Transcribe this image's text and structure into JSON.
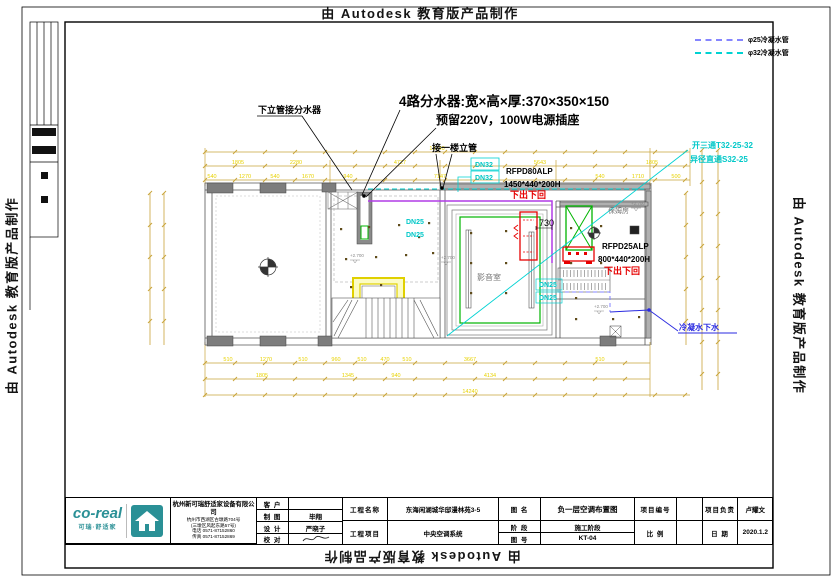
{
  "watermark": {
    "text": "由 Autodesk 教育版产品制作"
  },
  "legend": {
    "items": [
      {
        "label": "φ25冷凝水管",
        "color": "#8585ff"
      },
      {
        "label": "φ32冷凝水管",
        "color": "#00d2d2"
      }
    ]
  },
  "annotations": {
    "down_riser": "下立管接分水器",
    "manifold_note1": "4路分水器:宽×高×厚:370×350×150",
    "manifold_note2": "预留220V，100W电源插座",
    "first_floor_riser": "接一楼立管",
    "dn32_a": "DN32",
    "dn32_b": "DN32",
    "dn25_a": "DN25",
    "dn25_b": "DN25",
    "dn25_c": "DN25",
    "dn25_d": "DN25",
    "unit1_model": "RFPD80ALP",
    "unit1_size": "1450*440*200H",
    "unit1_flow": "下出下回",
    "unit2_model": "RFPD25ALP",
    "unit2_size": "800*440*200H",
    "unit2_flow": "下出下回",
    "tee": "开三通T32-25-32",
    "reducer": "异径直通S32-25",
    "condensate_drain": "冷凝水下水",
    "dim_730": "730",
    "room_cinema": "影音室",
    "room_nanny": "保姆房"
  },
  "levels": [
    "+2.700",
    "+2.700",
    "+2.700",
    "+2.700"
  ],
  "dimensions": {
    "top_total": {
      "x": 437,
      "y": 150,
      "t": "14240"
    },
    "rows": [
      {
        "y": 164,
        "items": [
          {
            "x": 238,
            "t": "1805"
          },
          {
            "x": 296,
            "t": "2280"
          },
          {
            "x": 400,
            "t": "4727"
          },
          {
            "x": 540,
            "t": "5643"
          },
          {
            "x": 652,
            "t": "1805"
          }
        ]
      },
      {
        "y": 178,
        "items": [
          {
            "x": 212,
            "t": "540"
          },
          {
            "x": 245,
            "t": "1270"
          },
          {
            "x": 275,
            "t": "540"
          },
          {
            "x": 308,
            "t": "1670"
          },
          {
            "x": 348,
            "t": "940"
          },
          {
            "x": 440,
            "t": "7147"
          },
          {
            "x": 600,
            "t": "540"
          },
          {
            "x": 638,
            "t": "1710"
          },
          {
            "x": 676,
            "t": "500"
          }
        ]
      },
      {
        "y": 361,
        "items": [
          {
            "x": 228,
            "t": "510"
          },
          {
            "x": 266,
            "t": "1270"
          },
          {
            "x": 303,
            "t": "510"
          },
          {
            "x": 336,
            "t": "960"
          },
          {
            "x": 362,
            "t": "510"
          },
          {
            "x": 385,
            "t": "470"
          },
          {
            "x": 407,
            "t": "510"
          },
          {
            "x": 470,
            "t": "3667"
          },
          {
            "x": 600,
            "t": "510"
          }
        ]
      },
      {
        "y": 377,
        "items": [
          {
            "x": 262,
            "t": "1805"
          },
          {
            "x": 348,
            "t": "1345"
          },
          {
            "x": 396,
            "t": "940"
          },
          {
            "x": 490,
            "t": "4134"
          }
        ]
      },
      {
        "y": 393,
        "items": [
          {
            "x": 470,
            "t": "14240"
          }
        ]
      }
    ]
  },
  "title_block": {
    "company": {
      "brand": "co-real",
      "tagline": "可瑞·舒适家",
      "name": "杭州新可瑞舒适家设备有限公司",
      "addr1": "杭州市西湖区古墩路704号",
      "addr2": "(三墩区风起东路57号)",
      "phone": "电话 0571-87152860",
      "fax": "传真 0571-87152869"
    },
    "fields": {
      "client_label": "客  户",
      "client": "",
      "draft_label": "制  图",
      "draft": "毕翔",
      "design_label": "设  计",
      "design": "严晓子",
      "check_label": "校  对",
      "project_name_label": "工程名称",
      "project_name": "东海闲湖城华邸漫林苑3-5",
      "project_item_label": "工程项目",
      "project_item": "中央空调系统",
      "drawing_name_label": "图  名",
      "drawing_name": "负一层空调布置图",
      "stage_label": "阶  段",
      "stage": "施工阶段",
      "drawing_no_label": "图  号",
      "drawing_no": "KT-04",
      "project_no_label": "项目编号",
      "project_no": "",
      "scale_label": "比  例",
      "scale": "",
      "lead_label": "项目负责",
      "lead": "卢耀文",
      "date_label": "日  期",
      "date": "2020.1.2"
    }
  },
  "colors": {
    "dimension_yellow": "#e8d200",
    "wall_gray": "#8a8a8a",
    "equipment_green": "#00b400",
    "unit_red": "#e60000",
    "pipe_cyan": "#00d2d2",
    "pipe_blue": "#8585ff",
    "drain_blue": "#2a2ae0",
    "pipe_purple": "#b03ce6",
    "brand_teal": "#2a9096"
  }
}
